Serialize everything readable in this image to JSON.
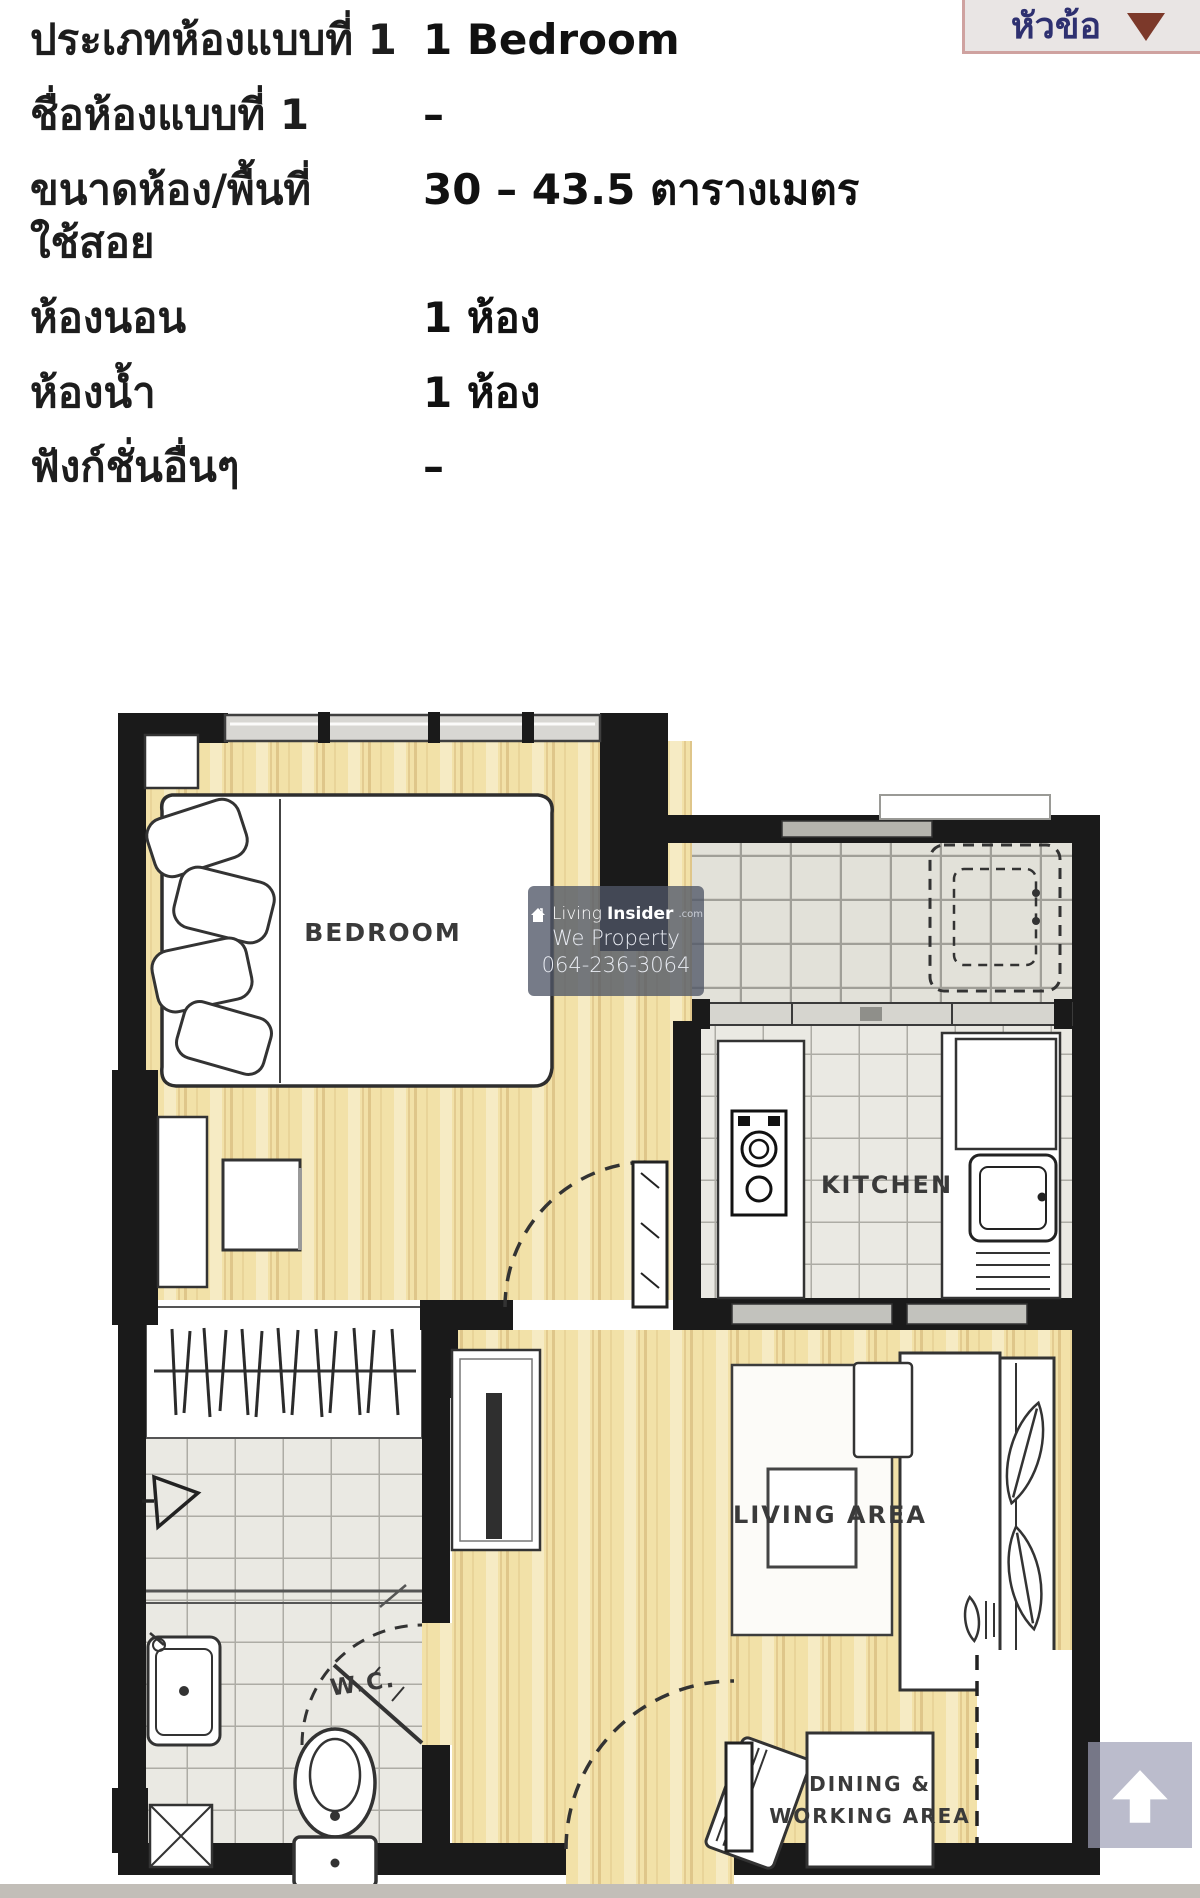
{
  "header": {
    "topic_button": {
      "label": "หัวข้อ"
    }
  },
  "details": {
    "rows": [
      {
        "label": "ประเภทห้องแบบที่ 1",
        "value": "1 Bedroom"
      },
      {
        "label": "ชื่อห้องแบบที่ 1",
        "value": "–"
      },
      {
        "label": "ขนาดห้อง/พื้นที่\nใช้สอย",
        "value": "30 – 43.5 ตารางเมตร"
      },
      {
        "label": "ห้องนอน",
        "value": "1 ห้อง"
      },
      {
        "label": "ห้องน้ำ",
        "value": "1 ห้อง"
      },
      {
        "label": "ฟังก์ชั่นอื่นๆ",
        "value": "–"
      }
    ]
  },
  "floorplan": {
    "labels": {
      "bedroom": "BEDROOM",
      "kitchen": "KITCHEN",
      "living": "LIVING AREA",
      "wc": "W.C.",
      "dining_line1": "DINING &",
      "dining_line2": "WORKING AREA"
    },
    "colors": {
      "wall": "#1a1a1a",
      "wood_floor": "#f2e1a8",
      "tile_floor": "#eae9e3",
      "balcony_tile": "#e2e1d9"
    }
  },
  "watermark": {
    "brand_light": "Living",
    "brand_bold": "Insider",
    "brand_suffix": ".com",
    "line2": "We Property",
    "line3": "064-236-3064"
  },
  "colors": {
    "topic_button_bg": "#e9e5e4",
    "topic_button_border": "#cfa2a0",
    "topic_button_text": "#2e3070",
    "topic_arrow": "#7c392a",
    "scroll_button_bg": "#9ea0b7"
  }
}
